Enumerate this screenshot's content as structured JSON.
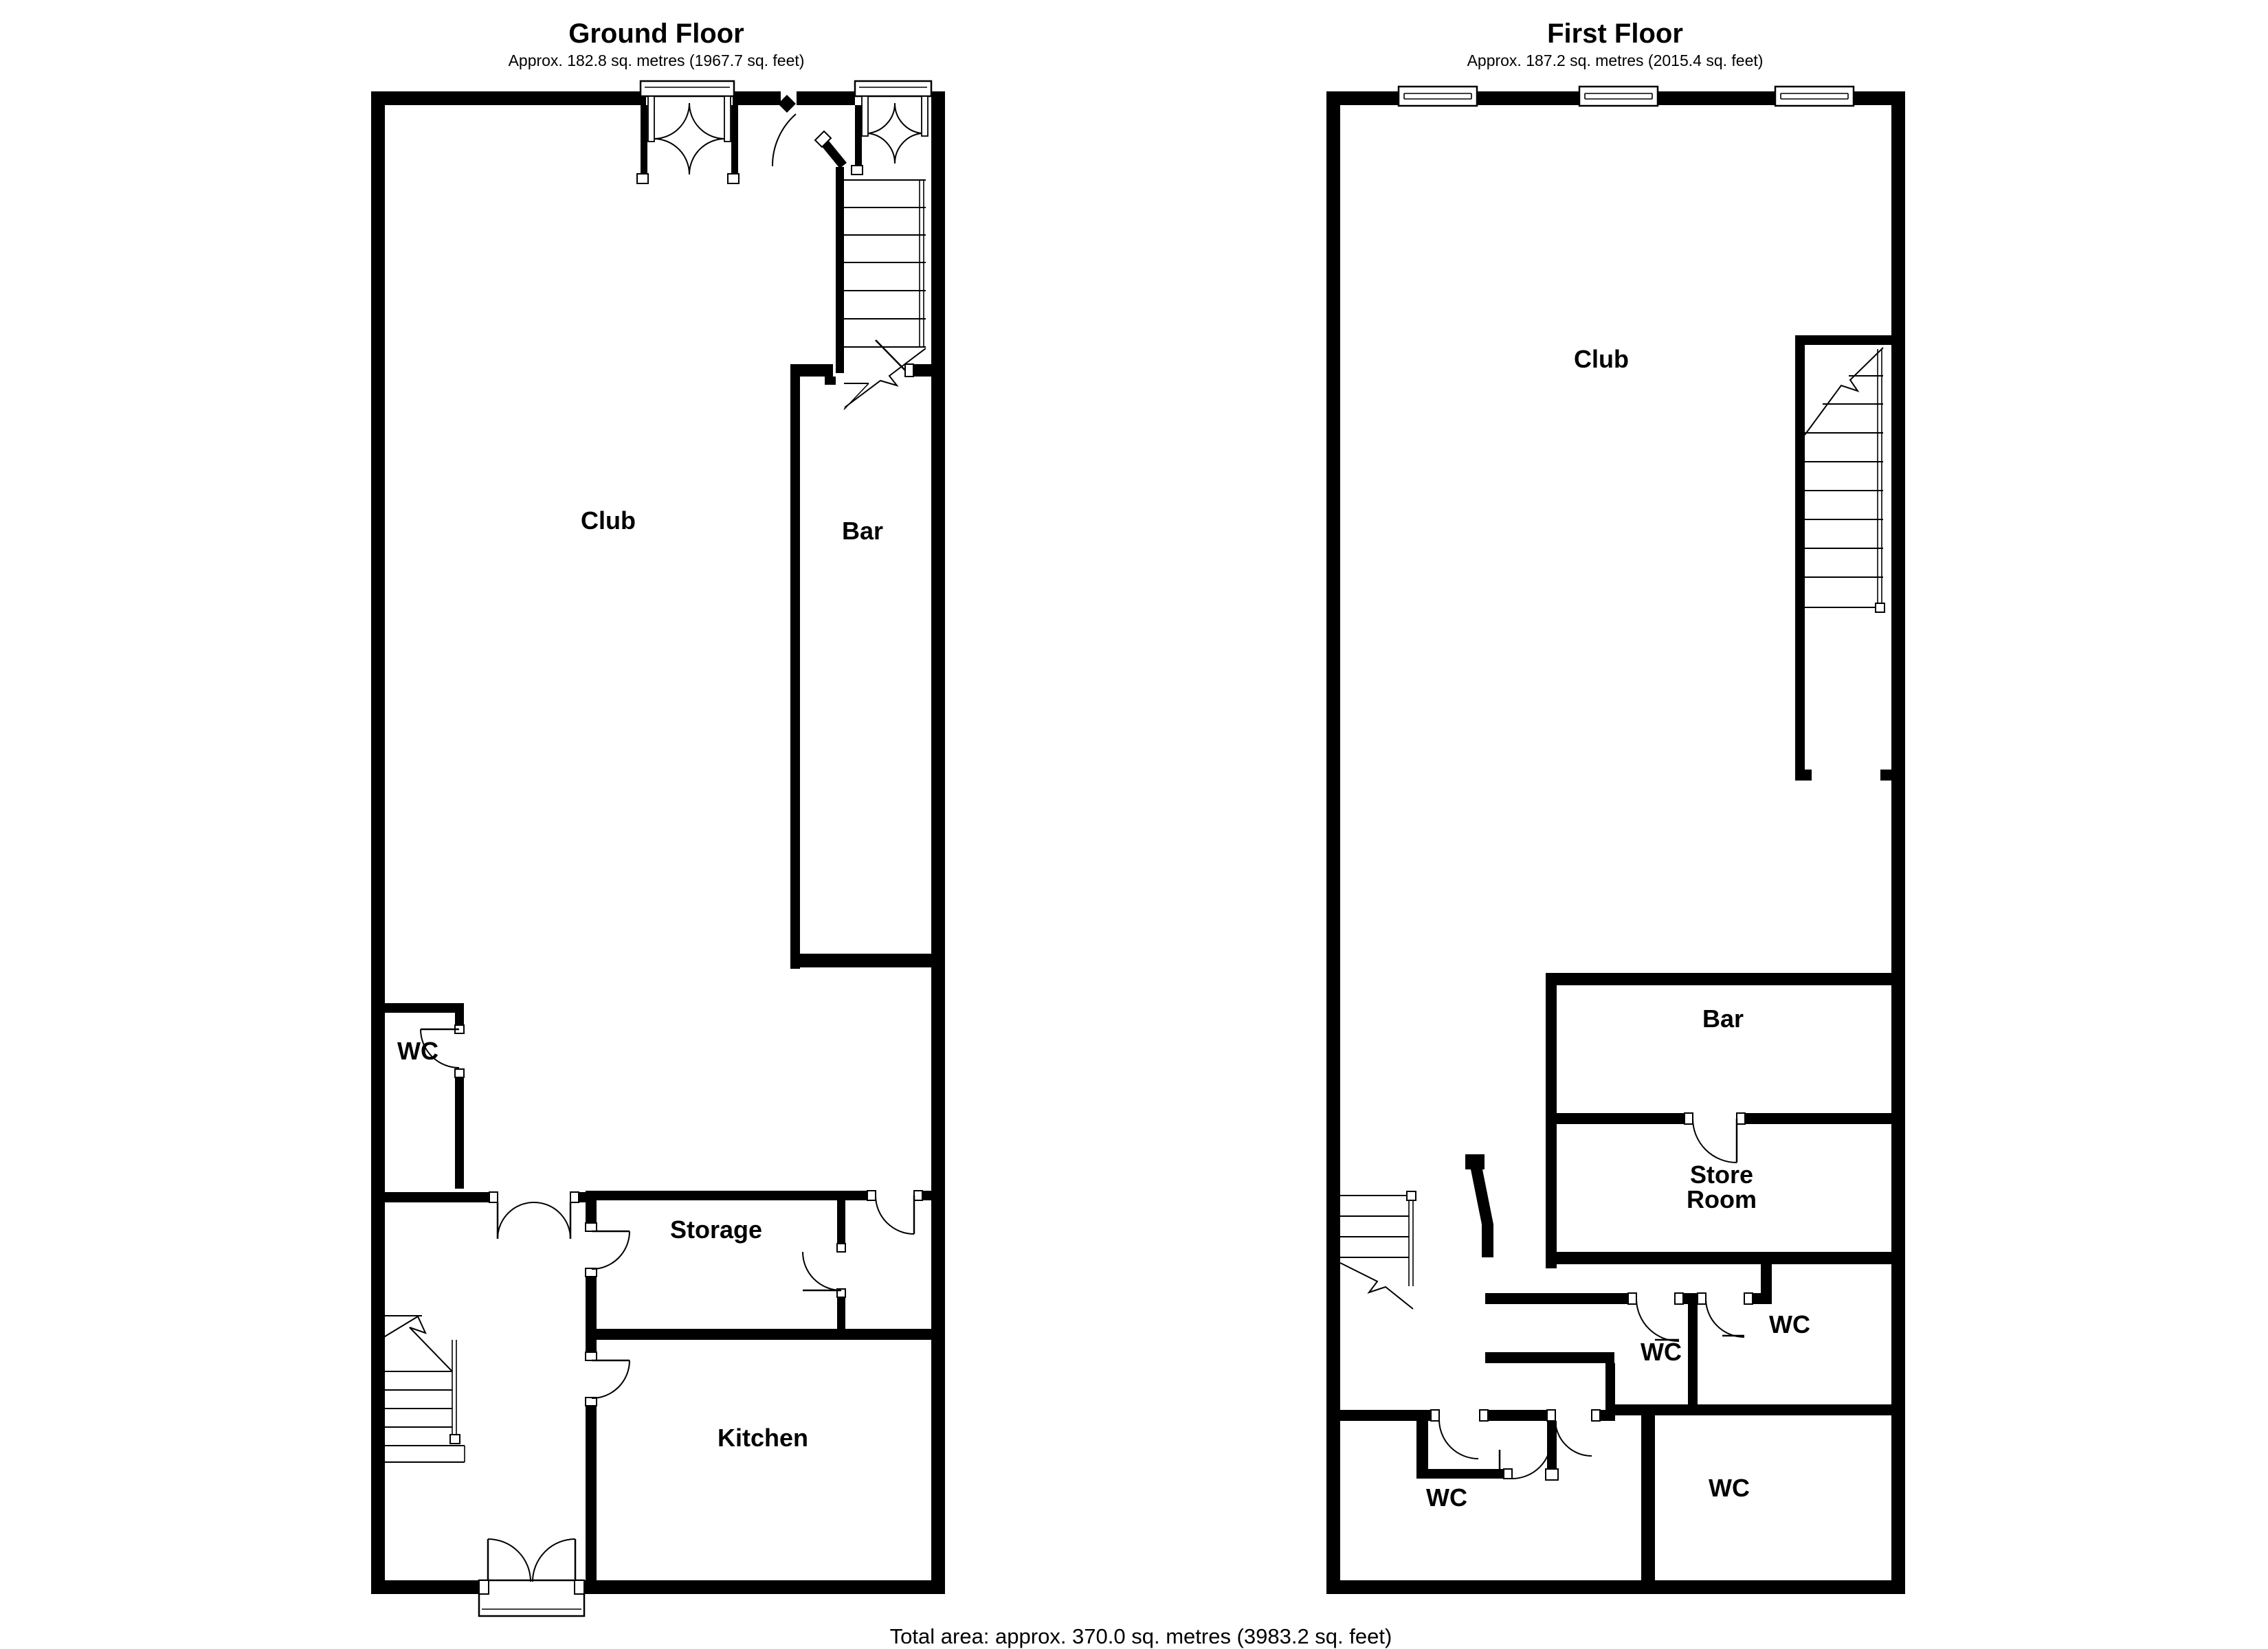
{
  "ground_floor": {
    "title": "Ground Floor",
    "subtitle": "Approx. 182.8 sq. metres (1967.7 sq. feet)",
    "rooms": {
      "club": {
        "label": "Club"
      },
      "bar": {
        "label": "Bar"
      },
      "wc": {
        "label": "WC"
      },
      "storage": {
        "label": "Storage"
      },
      "kitchen": {
        "label": "Kitchen"
      }
    }
  },
  "first_floor": {
    "title": "First Floor",
    "subtitle": "Approx. 187.2 sq. metres (2015.4 sq. feet)",
    "rooms": {
      "club": {
        "label": "Club"
      },
      "bar": {
        "label": "Bar"
      },
      "store_room": {
        "label_line1": "Store",
        "label_line2": "Room"
      },
      "wc_middle": {
        "label": "WC"
      },
      "wc_upper_right": {
        "label": "WC"
      },
      "wc_lower_left": {
        "label": "WC"
      },
      "wc_large": {
        "label": "WC"
      }
    }
  },
  "footer": {
    "total_area": "Total area: approx. 370.0 sq. metres (3983.2 sq. feet)"
  },
  "colors": {
    "wall": "#000000",
    "background": "#ffffff",
    "line": "#000000"
  }
}
